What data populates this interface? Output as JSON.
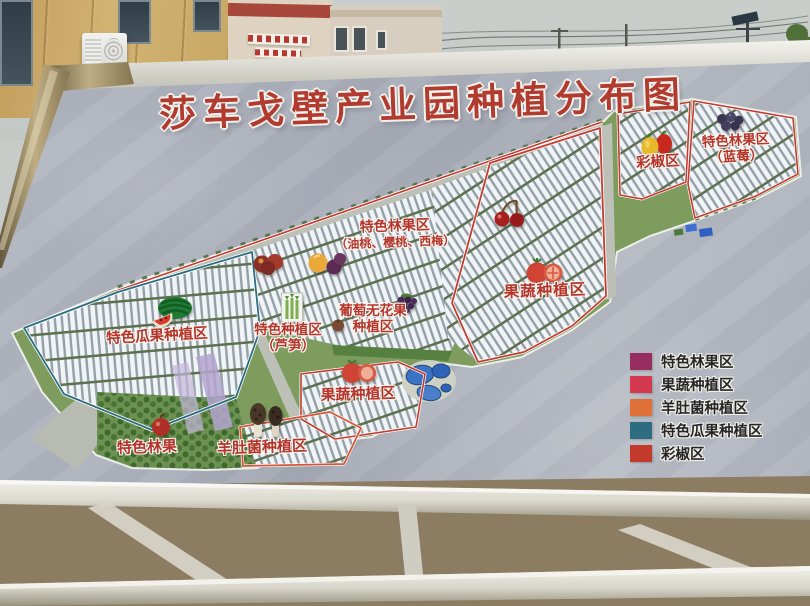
{
  "billboard": {
    "title": "莎车戈壁产业园种植分布图",
    "title_color": "#b23b30",
    "label_color": "#b5352b",
    "board_color": "#aeb3bd"
  },
  "map": {
    "labels": {
      "blueberry": {
        "line1": "特色林果区",
        "line2": "（蓝莓）"
      },
      "pepper": {
        "text": "彩椒区"
      },
      "forest_fruit": {
        "line1": "特色林果区",
        "line2": "（油桃、樱桃、西梅）"
      },
      "veg_upper": {
        "text": "果蔬种植区"
      },
      "grape_fig": {
        "line1": "葡萄无花果",
        "line2": "种植区"
      },
      "special": {
        "line1": "特色种植区",
        "line2": "（芦笋）"
      },
      "melon": {
        "text": "特色瓜果种植区"
      },
      "veg_lower": {
        "text": "果蔬种植区"
      },
      "forest_small": {
        "text": "特色林果"
      },
      "morel": {
        "text": "羊肚菌种植区"
      }
    },
    "icons": [
      "watermelon-icon",
      "asparagus-icon",
      "grape-icon",
      "fig-icon",
      "cherry-icon",
      "nectarine-icon",
      "peach-plum-icon",
      "tomato-icon",
      "bell-pepper-icon",
      "blueberry-icon",
      "apple-icon",
      "morel-mushroom-icon"
    ]
  },
  "legend": {
    "items": [
      {
        "label": "特色林果区",
        "color": "#962e60"
      },
      {
        "label": "果蔬种植区",
        "color": "#d4394f"
      },
      {
        "label": "羊肚菌种植区",
        "color": "#df7038"
      },
      {
        "label": "特色瓜果种植区",
        "color": "#2e6d80"
      },
      {
        "label": "彩椒区",
        "color": "#c33a2c"
      }
    ]
  }
}
